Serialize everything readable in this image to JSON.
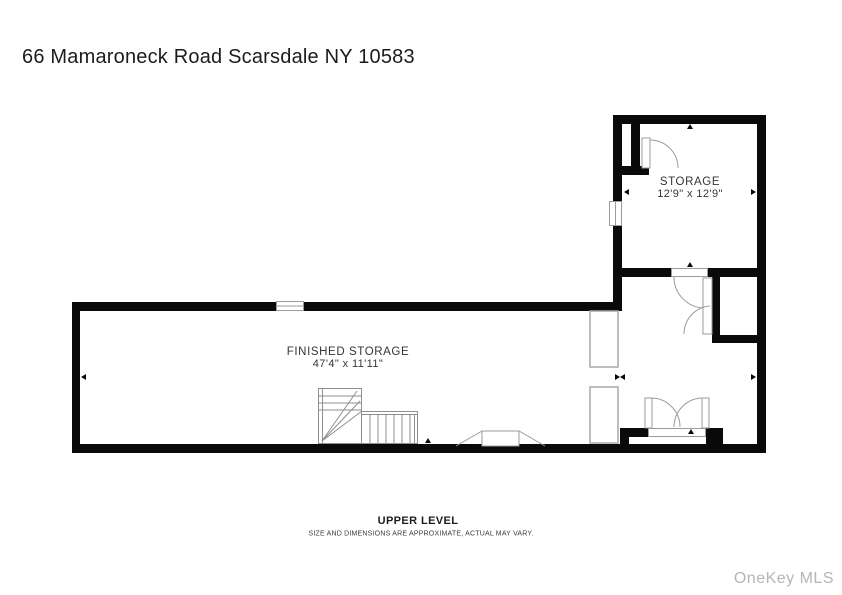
{
  "header": {
    "title": "66 Mamaroneck Road Scarsdale NY 10583"
  },
  "rooms": [
    {
      "name": "STORAGE",
      "dimensions": "12'9\" x 12'9\""
    },
    {
      "name": "FINISHED STORAGE",
      "dimensions": "47'4\" x 11'11\""
    }
  ],
  "footer": {
    "level": "UPPER LEVEL",
    "disclaimer": "SIZE AND DIMENSIONS ARE APPROXIMATE, ACTUAL MAY VARY."
  },
  "watermark": "OneKey MLS",
  "colors": {
    "wall": "#0a0a0a",
    "thin_line": "#9b9b9b",
    "text": "#353535",
    "watermark": "#b5b5b5"
  }
}
